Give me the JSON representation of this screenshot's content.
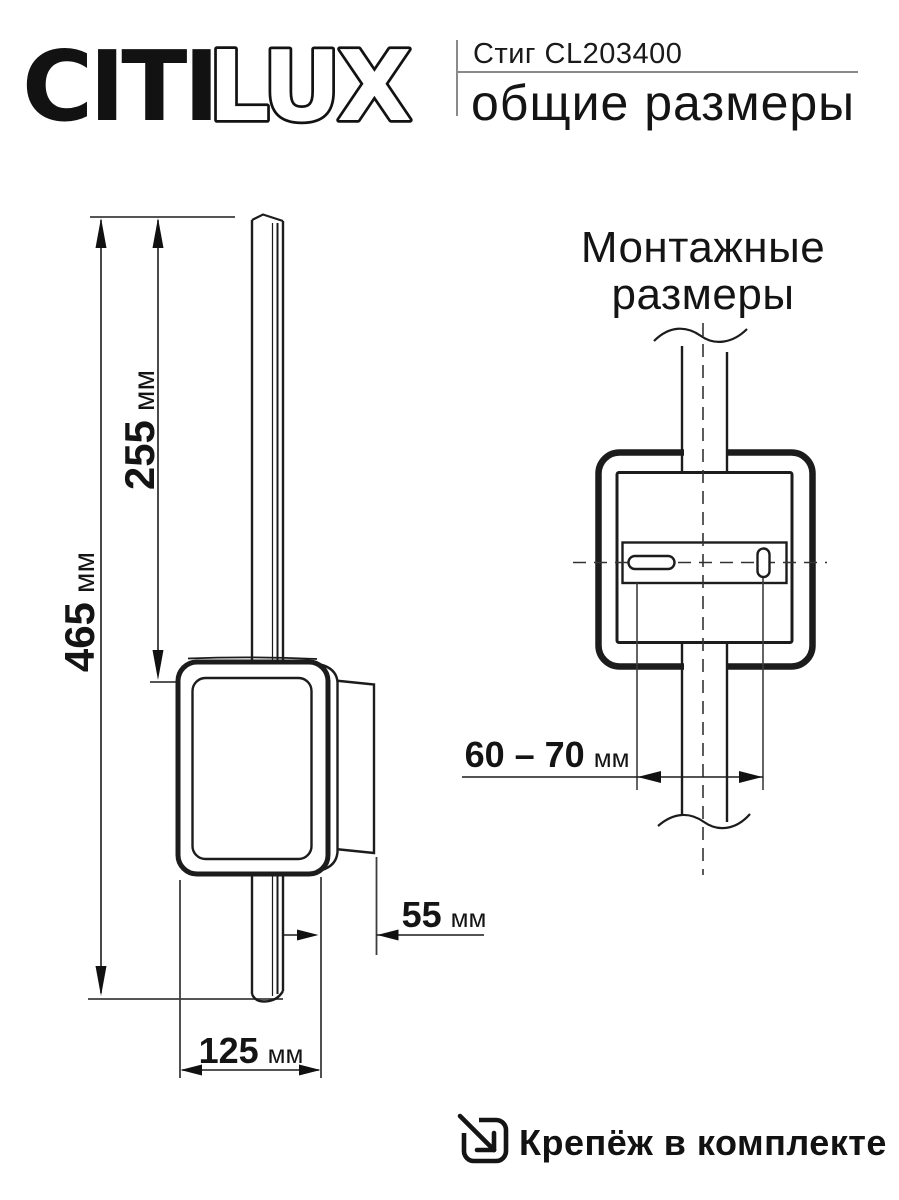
{
  "header": {
    "brand": {
      "part1": "CITI",
      "part2": "LUX"
    },
    "product_name": "Стиг CL203400",
    "subtitle": "общие размеры"
  },
  "overall_drawing": {
    "total_height": {
      "value": "465",
      "unit": "мм"
    },
    "upper_section_height": {
      "value": "255",
      "unit": "мм"
    },
    "depth": {
      "value": "55",
      "unit": "мм"
    },
    "width": {
      "value": "125",
      "unit": "мм"
    }
  },
  "mounting_drawing": {
    "title_line1": "Монтажные",
    "title_line2": "размеры",
    "hole_spacing": {
      "value": "60 – 70",
      "unit": "мм"
    }
  },
  "footer": {
    "label": "Крепёж в комплекте"
  }
}
